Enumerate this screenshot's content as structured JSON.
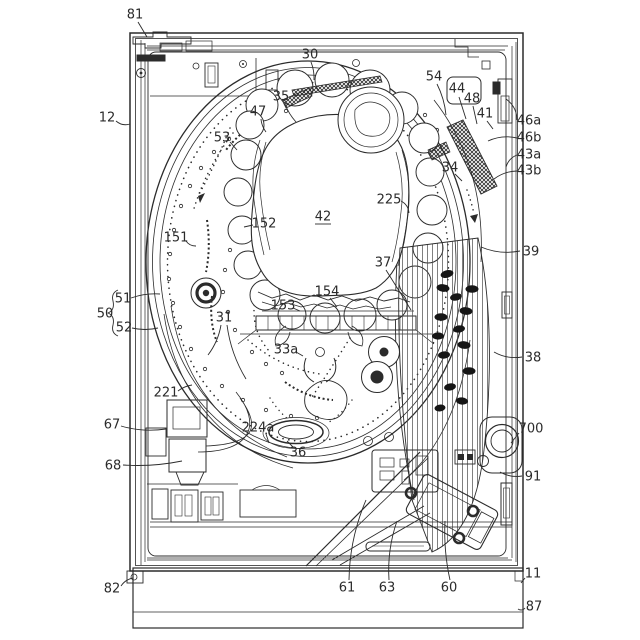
{
  "figure": {
    "kind": "patent-line-drawing",
    "subject": "pachinko gaming machine front frame with circular game board, center ornament window, lamp strips and ball launcher",
    "paper_color": "#ffffff",
    "ink_color": "#2b2b2b",
    "label_font_size": 13
  },
  "labels": [
    {
      "text": "81",
      "x": 135,
      "y": 15,
      "leaders": [
        [
          138,
          22,
          147,
          37,
          0
        ]
      ]
    },
    {
      "text": "12",
      "x": 107,
      "y": 118,
      "leaders": [
        [
          116,
          121,
          130,
          124,
          4
        ]
      ]
    },
    {
      "text": "30",
      "x": 310,
      "y": 55,
      "leaders": [
        [
          311,
          62,
          314,
          80,
          -2
        ]
      ]
    },
    {
      "text": "35",
      "x": 281,
      "y": 97,
      "leaders": [
        [
          285,
          104,
          296,
          122,
          2
        ]
      ]
    },
    {
      "text": "47",
      "x": 258,
      "y": 112,
      "leaders": [
        [
          261,
          119,
          266,
          132,
          2
        ]
      ]
    },
    {
      "text": "53",
      "x": 222,
      "y": 138,
      "leaders": [
        [
          230,
          142,
          237,
          150,
          0
        ]
      ]
    },
    {
      "text": "54",
      "x": 434,
      "y": 77,
      "leaders": [
        [
          437,
          84,
          446,
          115,
          -3
        ]
      ]
    },
    {
      "text": "44",
      "x": 457,
      "y": 89,
      "leaders": [
        [
          459,
          97,
          466,
          119,
          0
        ]
      ]
    },
    {
      "text": "48",
      "x": 472,
      "y": 99,
      "leaders": [
        [
          473,
          106,
          477,
          124,
          0
        ]
      ]
    },
    {
      "text": "41",
      "x": 485,
      "y": 114,
      "leaders": [
        [
          487,
          121,
          493,
          129,
          0
        ]
      ]
    },
    {
      "text": "46a",
      "x": 529,
      "y": 121,
      "leaders": [
        [
          517,
          120,
          506,
          99,
          6
        ]
      ]
    },
    {
      "text": "46b",
      "x": 529,
      "y": 138,
      "leaders": [
        [
          517,
          138,
          488,
          141,
          5
        ]
      ]
    },
    {
      "text": "43a",
      "x": 529,
      "y": 155,
      "leaders": [
        [
          517,
          155,
          506,
          167,
          4
        ]
      ]
    },
    {
      "text": "43b",
      "x": 529,
      "y": 171,
      "leaders": [
        [
          517,
          171,
          494,
          179,
          4
        ]
      ]
    },
    {
      "text": "34",
      "x": 450,
      "y": 168,
      "leaders": [
        [
          455,
          174,
          462,
          181,
          0
        ]
      ]
    },
    {
      "text": "225",
      "x": 389,
      "y": 200,
      "leaders": [
        [
          401,
          201,
          409,
          213,
          -4
        ]
      ]
    },
    {
      "text": "42",
      "x": 323,
      "y": 217,
      "underline": true
    },
    {
      "text": "152",
      "x": 264,
      "y": 224,
      "leaders": [
        [
          253,
          225,
          244,
          227,
          0
        ]
      ]
    },
    {
      "text": "151",
      "x": 176,
      "y": 238,
      "leaders": [
        [
          186,
          241,
          196,
          246,
          3
        ]
      ]
    },
    {
      "text": "37",
      "x": 383,
      "y": 263,
      "leaders": [
        [
          386,
          270,
          411,
          310,
          0
        ]
      ]
    },
    {
      "text": "154",
      "x": 327,
      "y": 292,
      "leaders": [
        [
          330,
          298,
          337,
          307,
          0
        ]
      ]
    },
    {
      "text": "153",
      "x": 283,
      "y": 306,
      "leaders": [
        [
          293,
          308,
          300,
          311,
          0
        ]
      ]
    },
    {
      "text": "31",
      "x": 224,
      "y": 318,
      "leaders": [
        [
          221,
          325,
          208,
          355,
          -4
        ],
        [
          227,
          325,
          246,
          379,
          6
        ]
      ]
    },
    {
      "text": "51",
      "x": 123,
      "y": 299,
      "leaders": [
        [
          131,
          298,
          160,
          294,
          -3
        ]
      ]
    },
    {
      "text": "50",
      "x": 105,
      "y": 314
    },
    {
      "text": "52",
      "x": 124,
      "y": 328,
      "leaders": [
        [
          132,
          328,
          158,
          328,
          3
        ]
      ]
    },
    {
      "text": "33a",
      "x": 286,
      "y": 350,
      "leaders": [
        [
          296,
          352,
          303,
          356,
          0
        ]
      ]
    },
    {
      "text": "39",
      "x": 531,
      "y": 252,
      "leaders": [
        [
          520,
          251,
          481,
          247,
          -6
        ]
      ]
    },
    {
      "text": "38",
      "x": 533,
      "y": 358,
      "leaders": [
        [
          522,
          357,
          494,
          352,
          -5
        ]
      ]
    },
    {
      "text": "221",
      "x": 166,
      "y": 393,
      "leaders": [
        [
          178,
          391,
          192,
          385,
          -2
        ]
      ]
    },
    {
      "text": "67",
      "x": 112,
      "y": 425,
      "leaders": [
        [
          121,
          426,
          166,
          429,
          5
        ]
      ]
    },
    {
      "text": "224a",
      "x": 258,
      "y": 428,
      "leaders": [
        [
          266,
          434,
          269,
          443,
          0
        ]
      ]
    },
    {
      "text": "36",
      "x": 298,
      "y": 453,
      "leaders": [
        [
          293,
          447,
          287,
          441,
          0
        ]
      ]
    },
    {
      "text": "700",
      "x": 531,
      "y": 429,
      "leaders": [
        [
          519,
          433,
          511,
          443,
          0
        ]
      ]
    },
    {
      "text": "68",
      "x": 113,
      "y": 466,
      "leaders": [
        [
          123,
          465,
          182,
          461,
          4
        ]
      ]
    },
    {
      "text": "91",
      "x": 533,
      "y": 477,
      "leaders": [
        [
          522,
          476,
          500,
          472,
          -4
        ]
      ]
    },
    {
      "text": "61",
      "x": 347,
      "y": 588,
      "leaders": [
        [
          349,
          580,
          366,
          500,
          -8
        ]
      ]
    },
    {
      "text": "63",
      "x": 387,
      "y": 588,
      "leaders": [
        [
          389,
          580,
          397,
          521,
          -6
        ]
      ]
    },
    {
      "text": "60",
      "x": 449,
      "y": 588,
      "leaders": [
        [
          450,
          580,
          445,
          521,
          -4
        ]
      ]
    },
    {
      "text": "82",
      "x": 112,
      "y": 589,
      "leaders": [
        [
          121,
          586,
          133,
          578,
          -3
        ]
      ]
    },
    {
      "text": "11",
      "x": 533,
      "y": 574,
      "leaders": [
        [
          525,
          578,
          521,
          583,
          0
        ]
      ]
    },
    {
      "text": "87",
      "x": 534,
      "y": 607,
      "leaders": [
        [
          525,
          608,
          518,
          609,
          -3
        ]
      ]
    }
  ]
}
